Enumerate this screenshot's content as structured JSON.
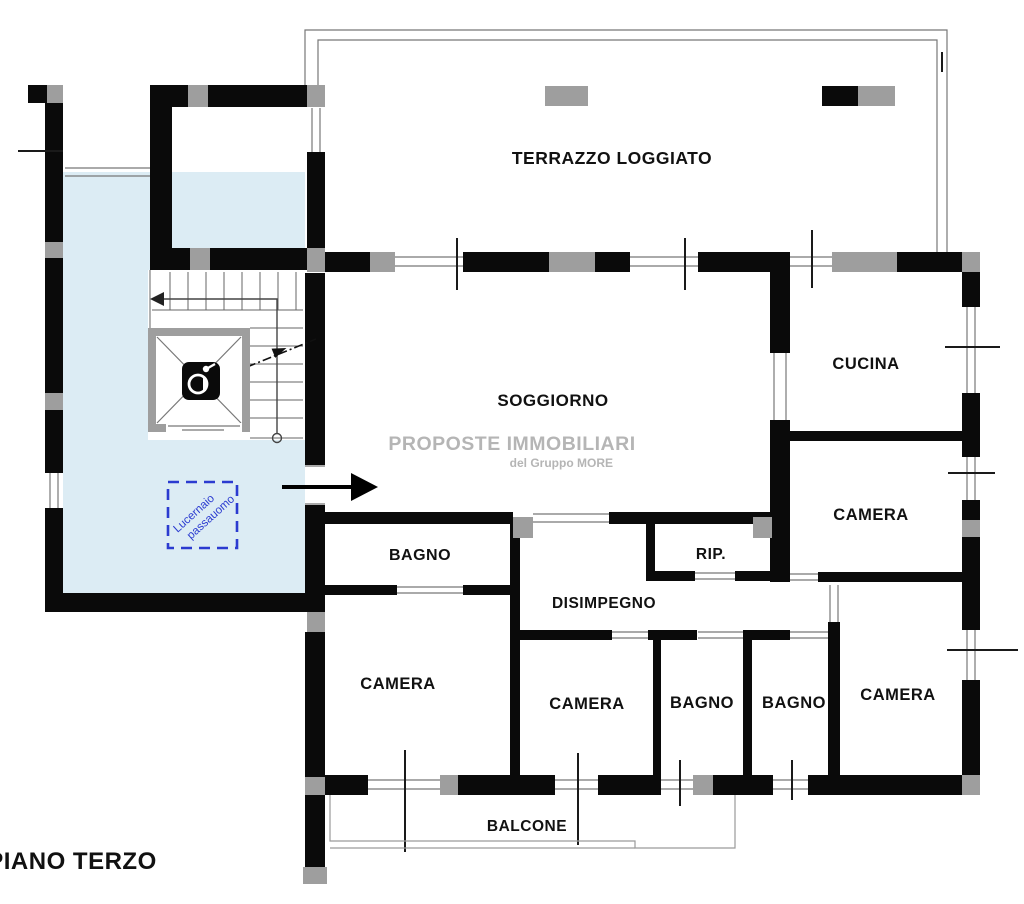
{
  "plan": {
    "title": "PIANO TERZO",
    "terrace_label": "TERRAZZO LOGGIATO",
    "rooms": {
      "soggiorno": "SOGGIORNO",
      "cucina": "CUCINA",
      "camera_right_upper": "CAMERA",
      "rip": "RIP.",
      "disimpegno": "DISIMPEGNO",
      "bagno_upper": "BAGNO",
      "camera_lower_left": "CAMERA",
      "camera_lower_center": "CAMERA",
      "bagno_lower_left": "BAGNO",
      "bagno_lower_right": "BAGNO",
      "camera_lower_right": "CAMERA",
      "balcone": "BALCONE"
    },
    "skylight_note": {
      "line1": "Lucernaio",
      "line2": "passauomo"
    },
    "watermark": {
      "line1": "PROPOSTE IMMOBILIARI",
      "line2": "del Gruppo MORE"
    },
    "colors": {
      "wall": "#0a0a0a",
      "pillar": "#9e9e9e",
      "stairwell_fill": "#dcecf4",
      "skylight_blue": "#2b3bd0",
      "watermark_gray": "#b5b5b5",
      "thin_line": "#777777",
      "label_color": "#111111"
    }
  }
}
